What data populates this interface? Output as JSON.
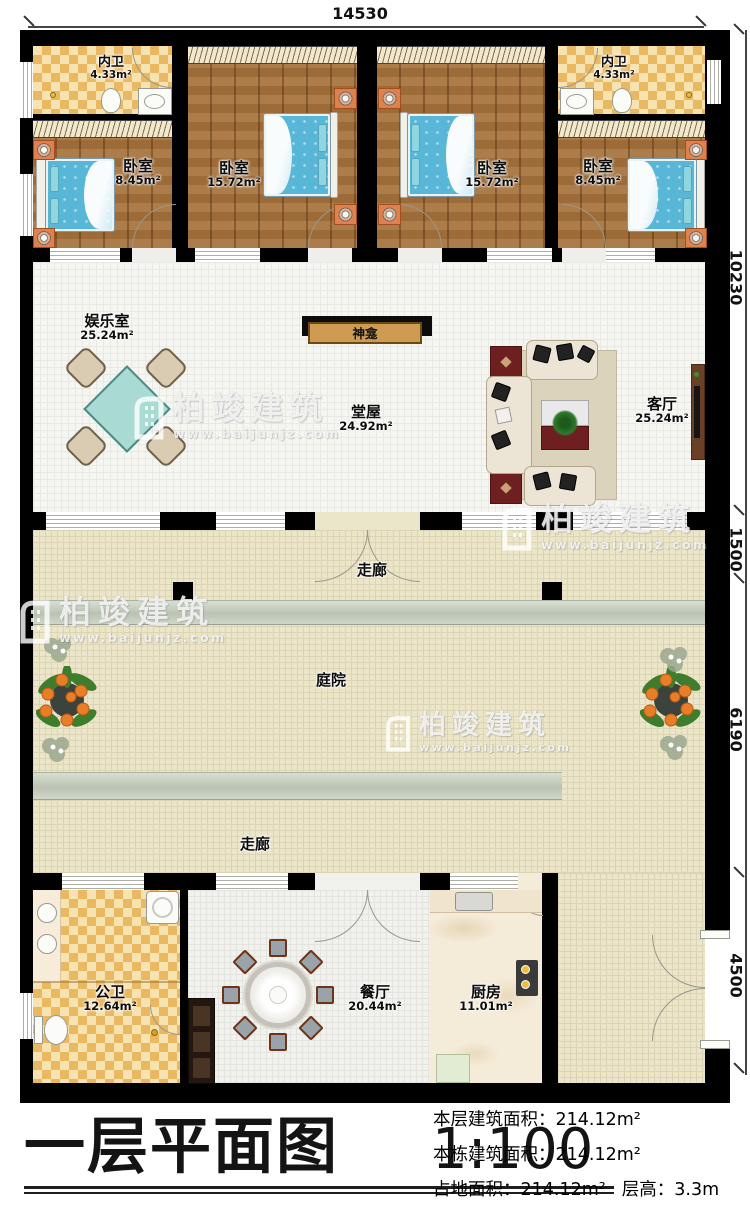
{
  "dims": {
    "top": "14530",
    "right": [
      "10230",
      "1500",
      "6190",
      "4500"
    ]
  },
  "rooms": {
    "inner_bath_left": {
      "name": "内卫",
      "area": "4.33m²"
    },
    "inner_bath_right": {
      "name": "内卫",
      "area": "4.33m²"
    },
    "bedroom_left": {
      "name": "卧室",
      "area": "8.45m²"
    },
    "bedroom_center_left": {
      "name": "卧室",
      "area": "15.72m²"
    },
    "bedroom_center_right": {
      "name": "卧室",
      "area": "15.72m²"
    },
    "bedroom_right": {
      "name": "卧室",
      "area": "8.45m²"
    },
    "recreation_room": {
      "name": "娱乐室",
      "area": "25.24m²"
    },
    "shrine": {
      "name": "神龛"
    },
    "main_hall": {
      "name": "堂屋",
      "area": "24.92m²"
    },
    "living_room": {
      "name": "客厅",
      "area": "25.24m²"
    },
    "corridor_upper": {
      "name": "走廊"
    },
    "courtyard": {
      "name": "庭院"
    },
    "corridor_lower": {
      "name": "走廊"
    },
    "public_bath": {
      "name": "公卫",
      "area": "12.64m²"
    },
    "dining_room": {
      "name": "餐厅",
      "area": "20.44m²"
    },
    "kitchen": {
      "name": "厨房",
      "area": "11.01m²"
    }
  },
  "title": {
    "text": "一层平面图",
    "scale": "1:100"
  },
  "info": {
    "line1_label": "本层建筑面积：",
    "line1_value": "214.12m²",
    "line2_label": "本栋建筑面积：",
    "line2_value": "214.12m²",
    "line3_label": "占地面积：",
    "line3_value": "214.12m²",
    "line4_label": "层高：",
    "line4_value": "3.3m"
  },
  "watermark": {
    "brand": "柏竣建筑",
    "site": "www.baijunjz.com"
  }
}
